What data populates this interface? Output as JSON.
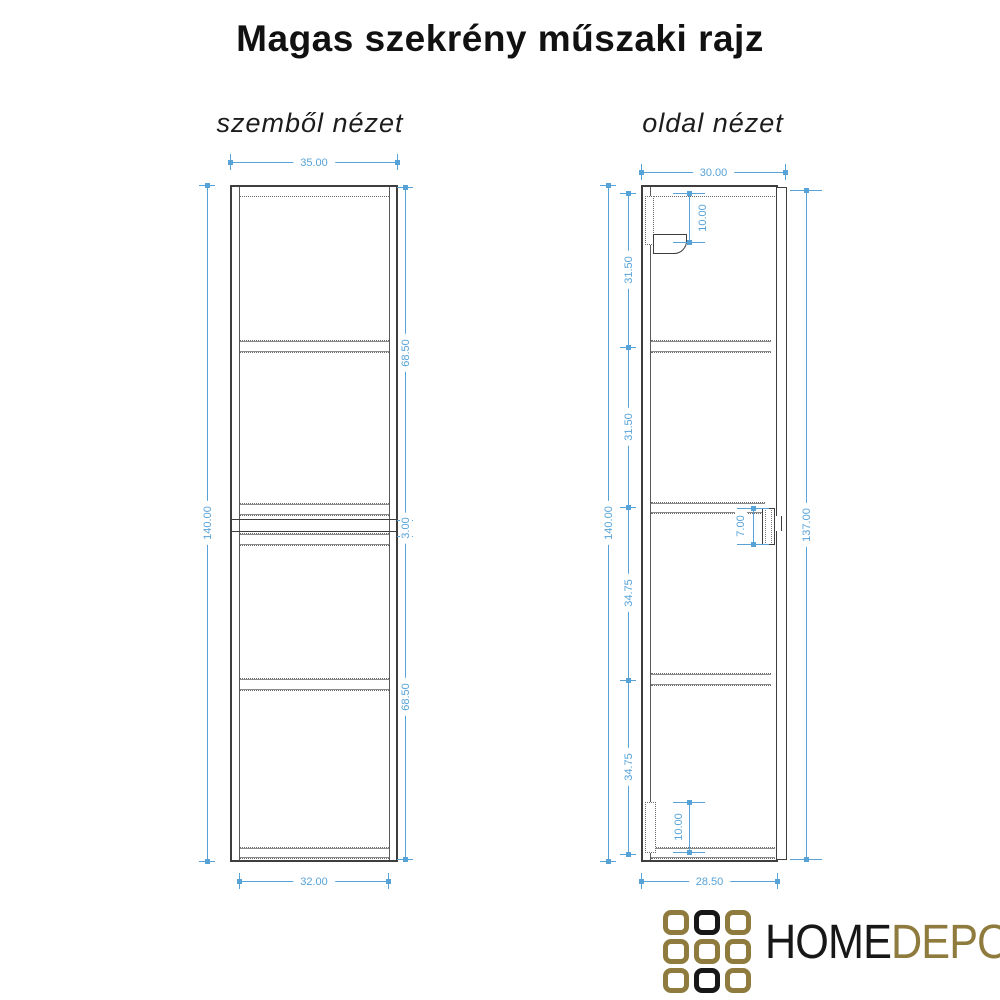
{
  "title": "Magas szekrény műszaki rajz",
  "views": {
    "front": {
      "label": "szemből nézet",
      "dims": {
        "top_width": "35.00",
        "height": "140.00",
        "upper_section": "68.50",
        "middle_gap": "3.00",
        "lower_section": "68.50",
        "bottom_width": "32.00"
      }
    },
    "side": {
      "label": "oldal nézet",
      "dims": {
        "top_depth": "30.00",
        "height": "140.00",
        "front_height": "137.00",
        "seg_1": "31.50",
        "seg_2": "31.50",
        "seg_3": "34.75",
        "seg_4": "34.75",
        "top_bracket_height": "10.00",
        "mid_bracket_depth": "7.00",
        "bottom_bracket_height": "10.00",
        "bottom_depth": "28.50"
      }
    }
  },
  "logo": {
    "text_primary": "HOME",
    "text_secondary": "DEPO",
    "colors": {
      "gold": "#8e7b3d",
      "dark": "#171717"
    },
    "grid_pattern": [
      "gold",
      "dark",
      "gold",
      "gold",
      "gold",
      "gold",
      "gold",
      "dark",
      "gold"
    ]
  },
  "colors": {
    "dimension": "#57a3d8",
    "drawing_line": "#3e3e3e"
  }
}
